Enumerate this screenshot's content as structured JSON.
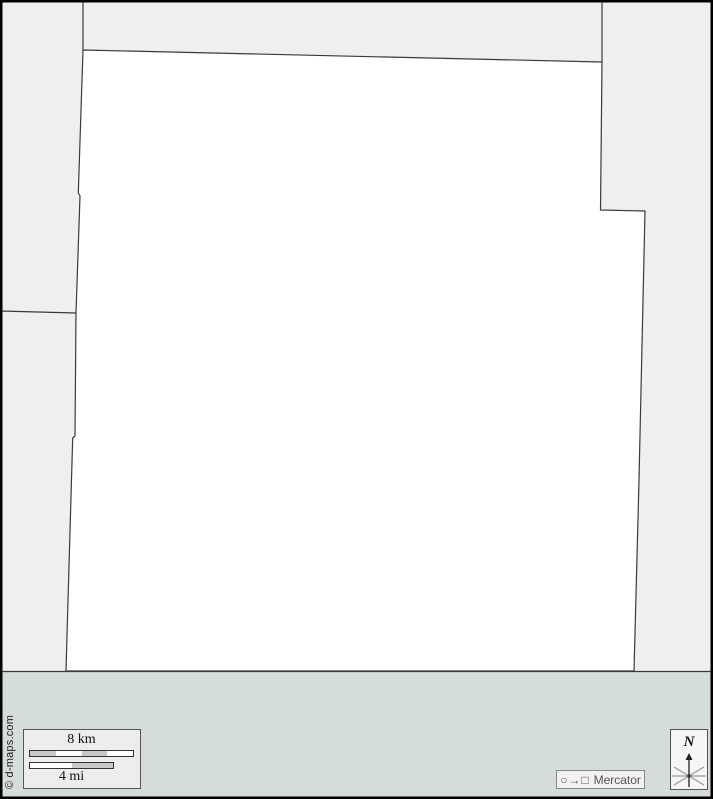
{
  "page": {
    "width": 713,
    "height": 799
  },
  "map": {
    "land_color": "#efefef",
    "region_color": "#ffffff",
    "water_color": "#d4ddda",
    "boundary_color": "#3a3a3a",
    "frame_color": "#000000",
    "main_region_points": "83,50 602,62 600.5,210 645,211 639,480 634,671 66,671 72.7,438 75,436 76,313 80,196 78.3,193",
    "border_top_left": "83,0 83,50",
    "border_top_right": "602,0 602,62",
    "border_left": "0,311 76,313",
    "shoreline": "0,671.5 713,671.5"
  },
  "scale_box": {
    "km_label": "8 km",
    "mi_label": "4 mi",
    "km_segment_colors": [
      "#c9c9c9",
      "#ffffff",
      "#c9c9c9",
      "#ffffff"
    ],
    "mi_segment_colors": [
      "#ffffff",
      "#c9c9c9"
    ]
  },
  "projection_box": {
    "symbols": "○→□",
    "label": "Mercator"
  },
  "compass_box": {
    "label": "N"
  },
  "copyright": "© d-maps.com"
}
